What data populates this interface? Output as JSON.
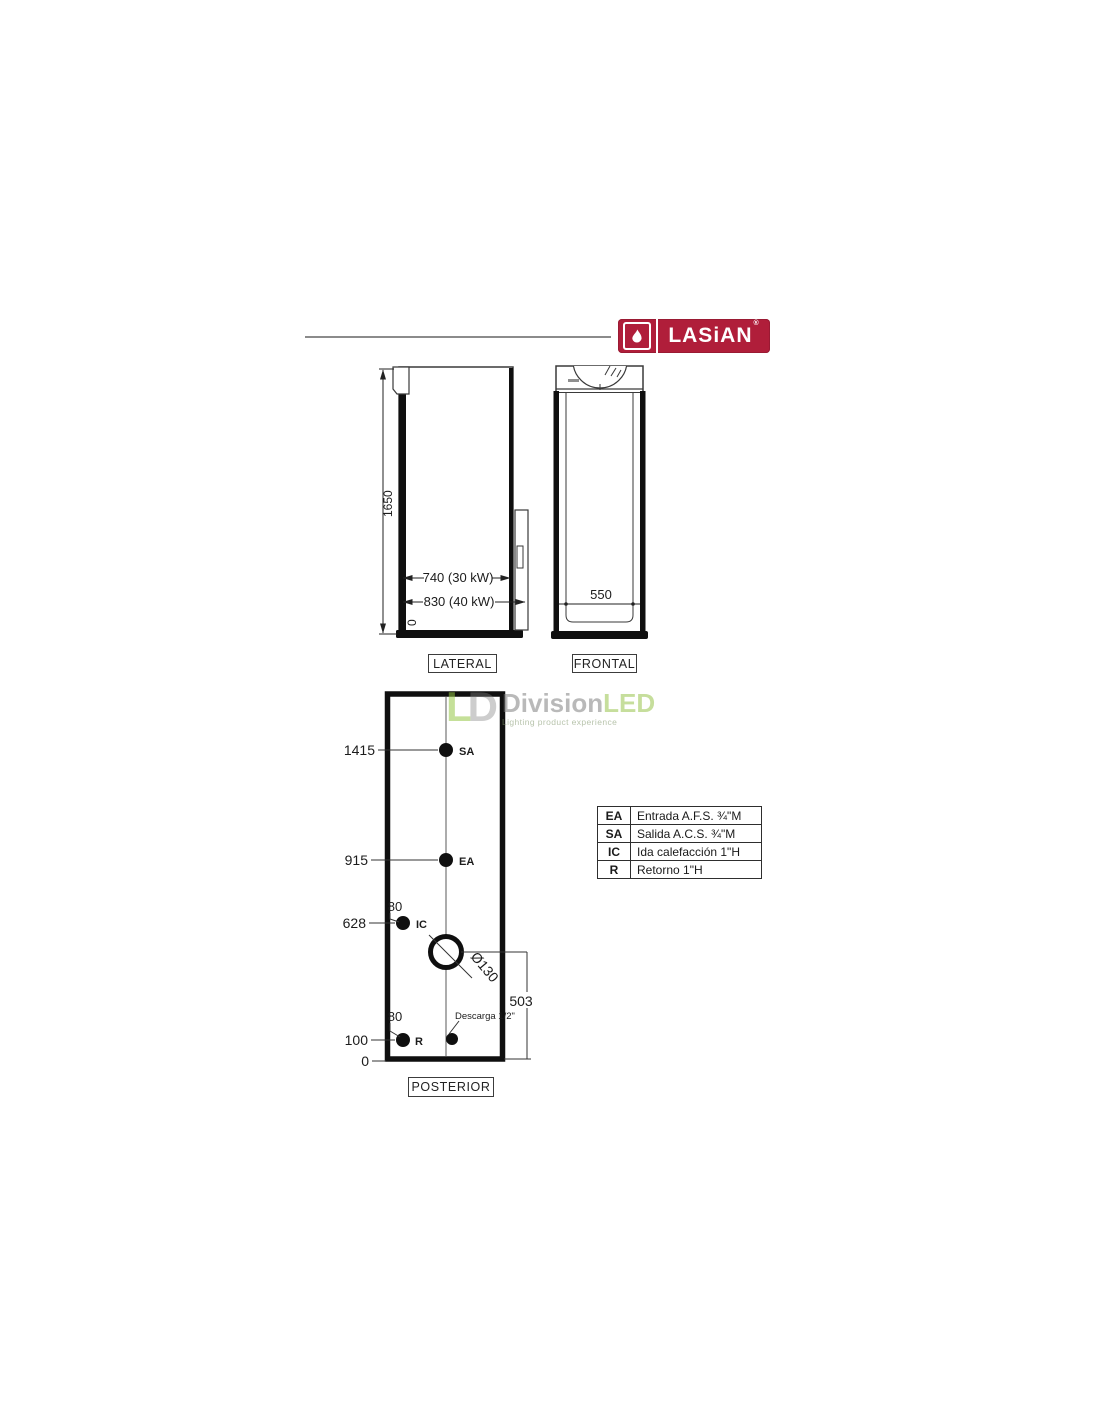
{
  "brand": {
    "part1": "LAS",
    "part2": "i",
    "part3": "AN",
    "reg": "®",
    "accent_color": "#B01E3A",
    "flame_icon": "flame"
  },
  "watermark": {
    "monogram1": "L",
    "monogram2": "D",
    "word1": "Division",
    "word2": "LED",
    "tagline": "Lighting product experience",
    "green": "#9CC94A",
    "gray": "#9B9B9B"
  },
  "views": {
    "lateral": {
      "label": "LATERAL",
      "dims": {
        "height": "1650",
        "zero": "0",
        "depth_30kw": "740 (30 kW)",
        "depth_40kw": "830 (40 kW)"
      }
    },
    "frontal": {
      "label": "FRONTAL",
      "dims": {
        "width": "550"
      }
    },
    "posterior": {
      "label": "POSTERIOR",
      "dims": {
        "sa_height": "1415",
        "ea_height": "915",
        "ic_height": "628",
        "r_height": "100",
        "zero": "0",
        "ic_offset": "80",
        "r_offset": "80",
        "flue_diameter": "Ø130",
        "flue_height": "503"
      },
      "points": {
        "sa": "SA",
        "ea": "EA",
        "ic": "IC",
        "r": "R"
      },
      "drain_label": "Descarga 1/2\""
    }
  },
  "legend": {
    "rows": [
      {
        "code": "EA",
        "desc": "Entrada A.F.S. ¾\"M"
      },
      {
        "code": "SA",
        "desc": "Salida A.C.S. ¾\"M"
      },
      {
        "code": "IC",
        "desc": "Ida calefacción 1\"H"
      },
      {
        "code": "R",
        "desc": "Retorno 1\"H"
      }
    ]
  }
}
